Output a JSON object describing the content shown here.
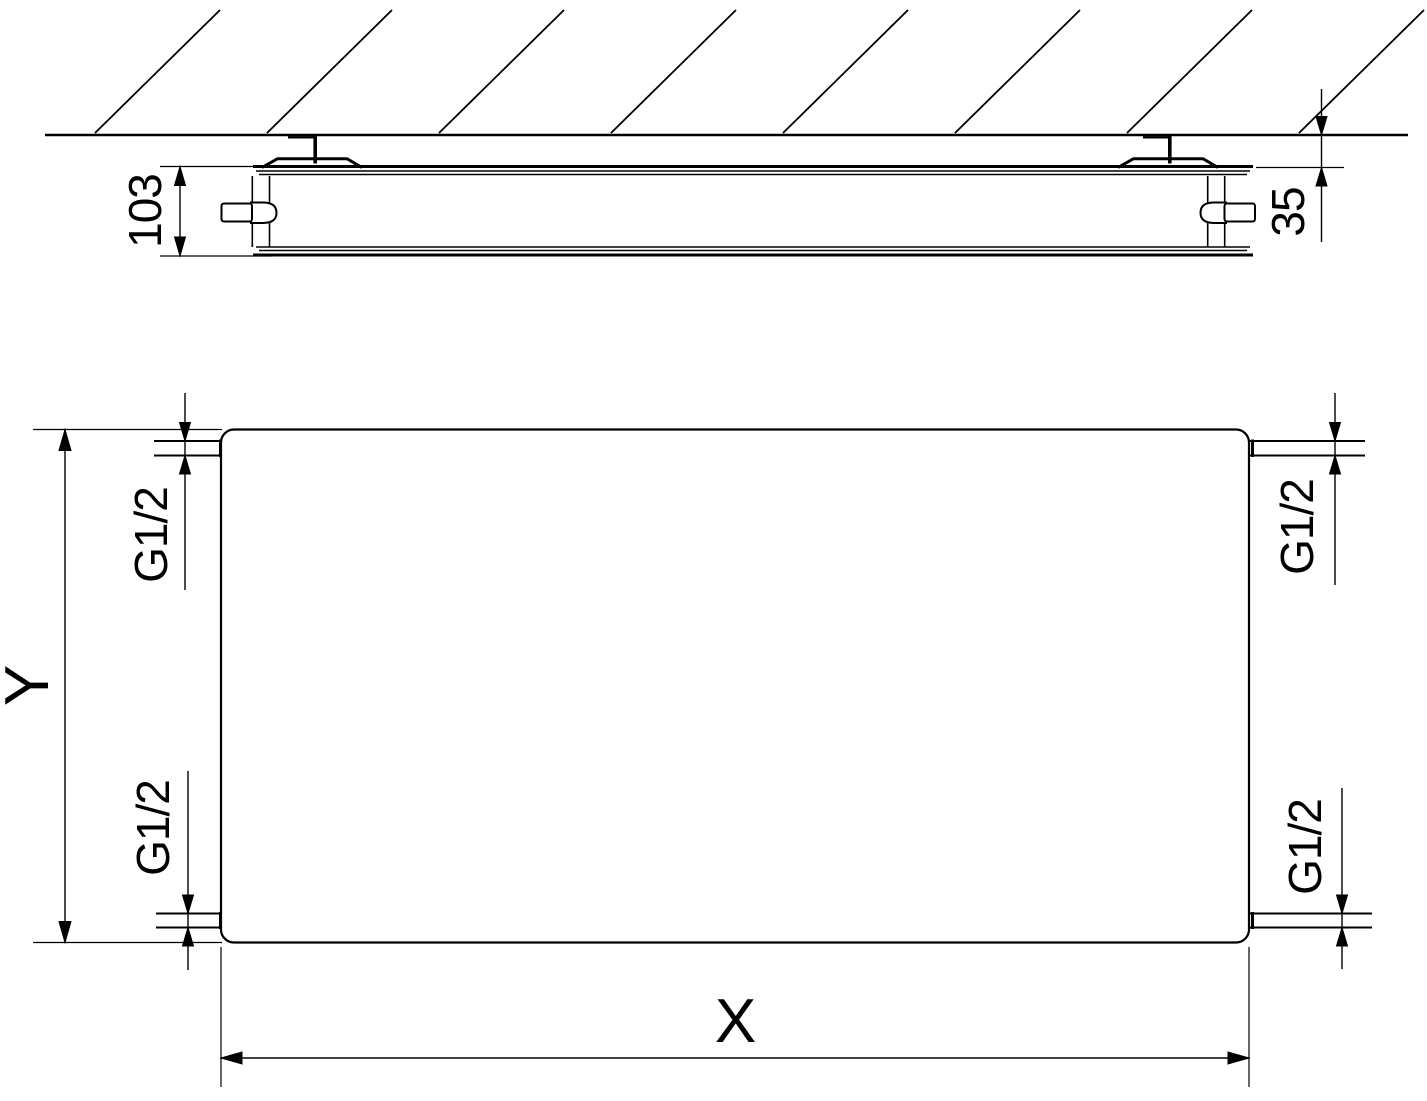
{
  "drawing": {
    "background": "#ffffff",
    "line_color": "#000000",
    "side_view": {
      "depth_label": "103",
      "wall_distance_label": "35"
    },
    "front_view": {
      "width_label": "X",
      "height_label": "Y",
      "connections": {
        "top_left": "G1/2",
        "top_right": "G1/2",
        "bottom_left": "G1/2",
        "bottom_right": "G1/2"
      }
    }
  }
}
